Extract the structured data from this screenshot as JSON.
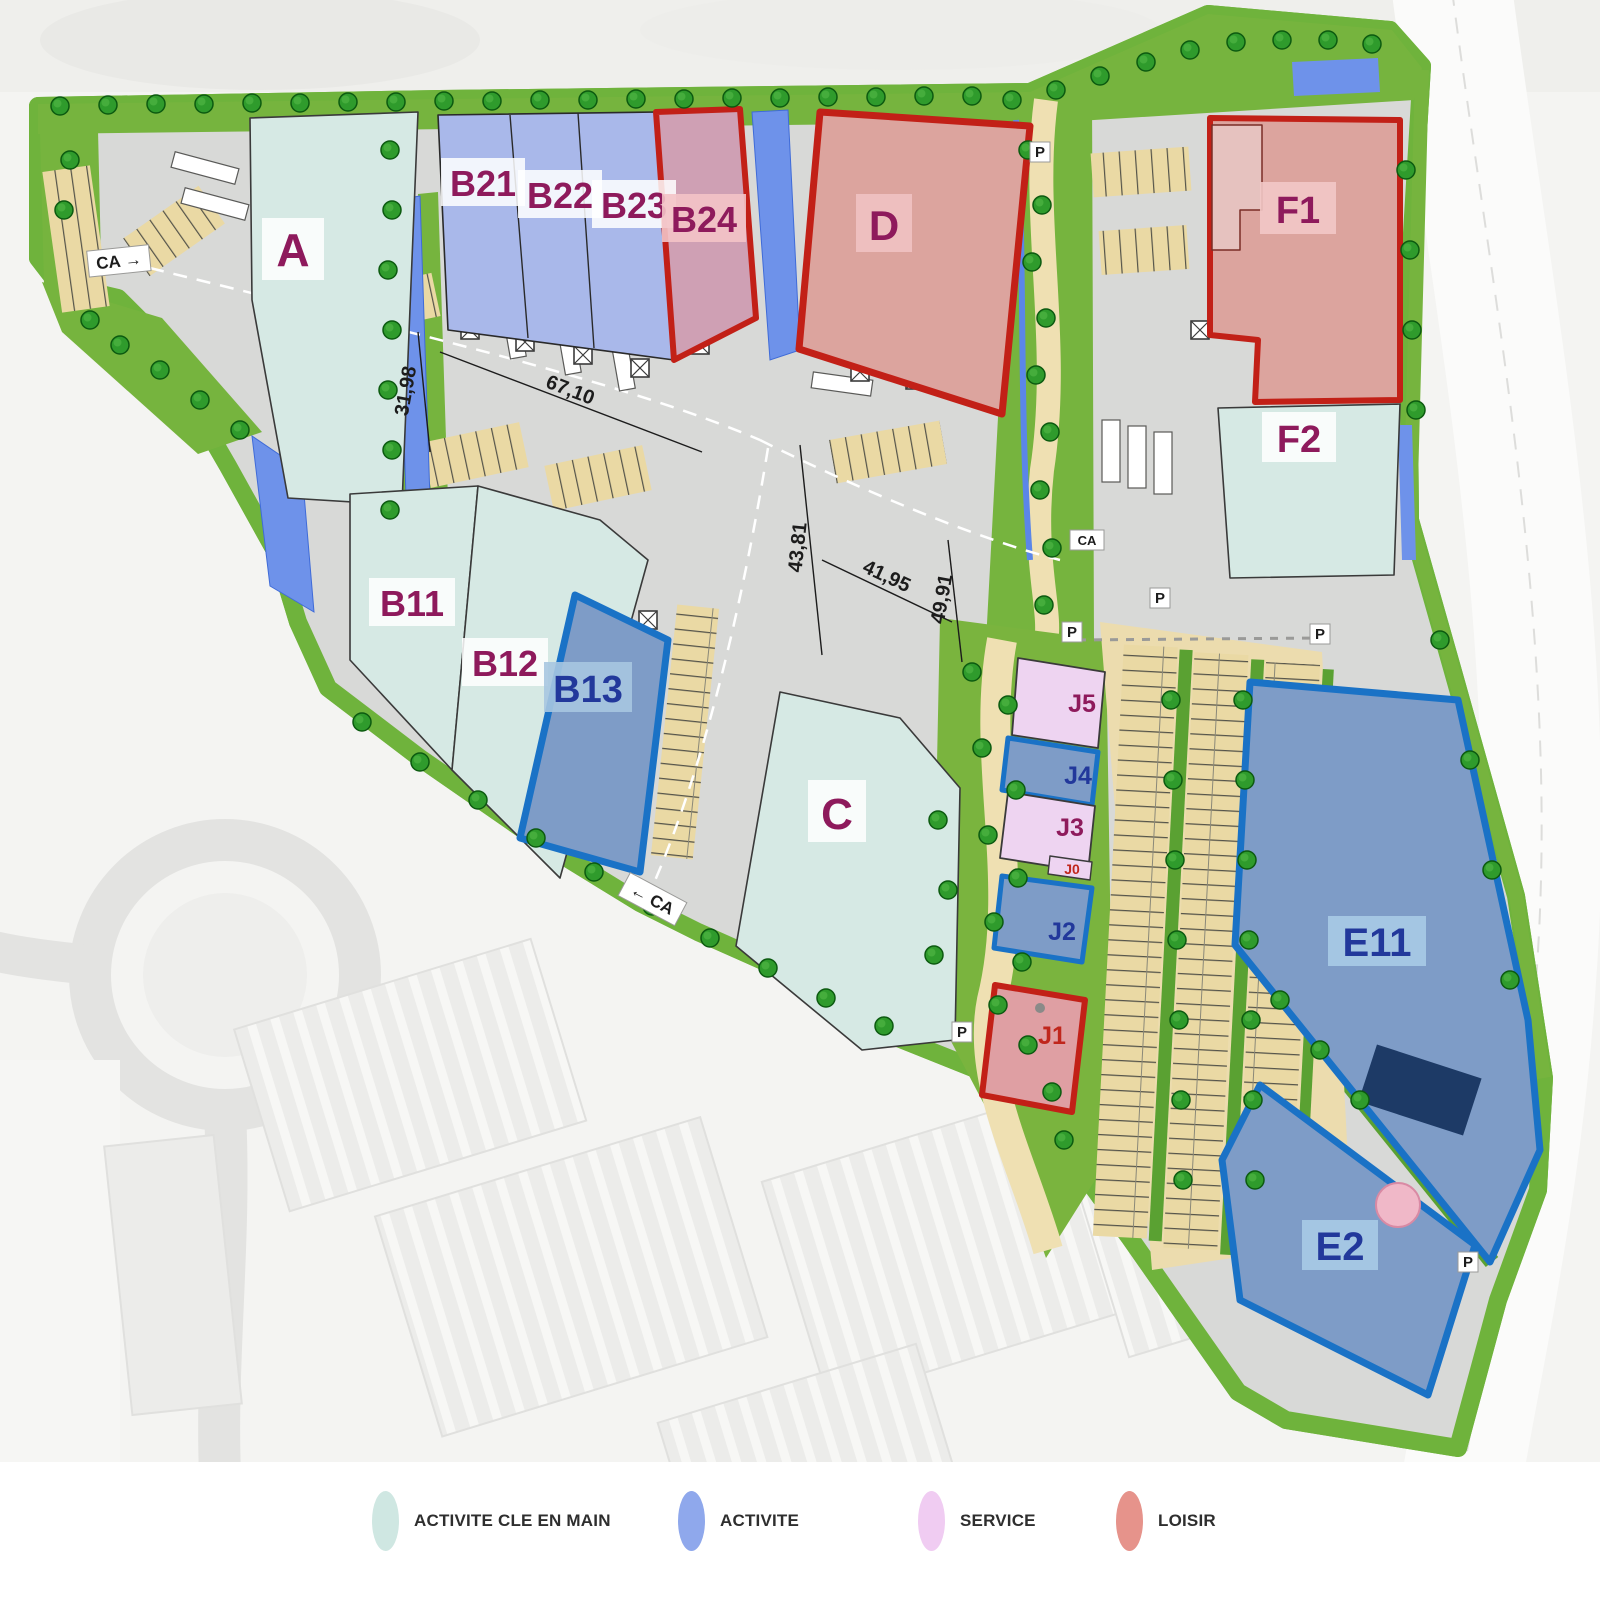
{
  "legend": {
    "items": [
      {
        "label": "ACTIVITE CLE EN MAIN",
        "color": "#cfe7e2"
      },
      {
        "label": "ACTIVITE",
        "color": "#8fa8ec"
      },
      {
        "label": "SERVICE",
        "color": "#f0ccf2"
      },
      {
        "label": "LOISIR",
        "color": "#e6938b"
      }
    ]
  },
  "lots": {
    "A": {
      "label": "A",
      "category": "activite-cle-en-main"
    },
    "B11": {
      "label": "B11",
      "category": "activite-cle-en-main"
    },
    "B12": {
      "label": "B12",
      "category": "activite-cle-en-main"
    },
    "B13": {
      "label": "B13",
      "category": "activite"
    },
    "B21": {
      "label": "B21",
      "category": "activite"
    },
    "B22": {
      "label": "B22",
      "category": "activite"
    },
    "B23": {
      "label": "B23",
      "category": "activite"
    },
    "B24": {
      "label": "B24",
      "category": "loisir"
    },
    "C": {
      "label": "C",
      "category": "activite-cle-en-main"
    },
    "D": {
      "label": "D",
      "category": "loisir"
    },
    "E11": {
      "label": "E11",
      "category": "activite"
    },
    "E2": {
      "label": "E2",
      "category": "activite"
    },
    "F1": {
      "label": "F1",
      "category": "loisir"
    },
    "F2": {
      "label": "F2",
      "category": "activite-cle-en-main"
    },
    "J0": {
      "label": "J0",
      "category": "service"
    },
    "J1": {
      "label": "J1",
      "category": "loisir"
    },
    "J2": {
      "label": "J2",
      "category": "activite"
    },
    "J3": {
      "label": "J3",
      "category": "service"
    },
    "J4": {
      "label": "J4",
      "category": "activite"
    },
    "J5": {
      "label": "J5",
      "category": "service"
    }
  },
  "dimensions": {
    "d1": "67,10",
    "d2": "31,98",
    "d3": "43,81",
    "d4": "41,95",
    "d5": "49,91"
  },
  "markers": {
    "parking": "P",
    "ca_in": "CA →",
    "ca_out": "← CA",
    "ca": "CA"
  },
  "colors": {
    "teal": "#d6e9e4",
    "periwinkle": "#a9b8ea",
    "steel": "#7e9cc7",
    "salmon": "#dca49e",
    "mauve": "#cfa0b4",
    "pink": "#eed4f1",
    "salmon_j1": "#df9fa3",
    "red_border": "#c22017",
    "blue_border": "#1a72c6",
    "maroon_text": "#8e1a5c",
    "navy_text": "#22389b",
    "red_text": "#c0261c"
  }
}
